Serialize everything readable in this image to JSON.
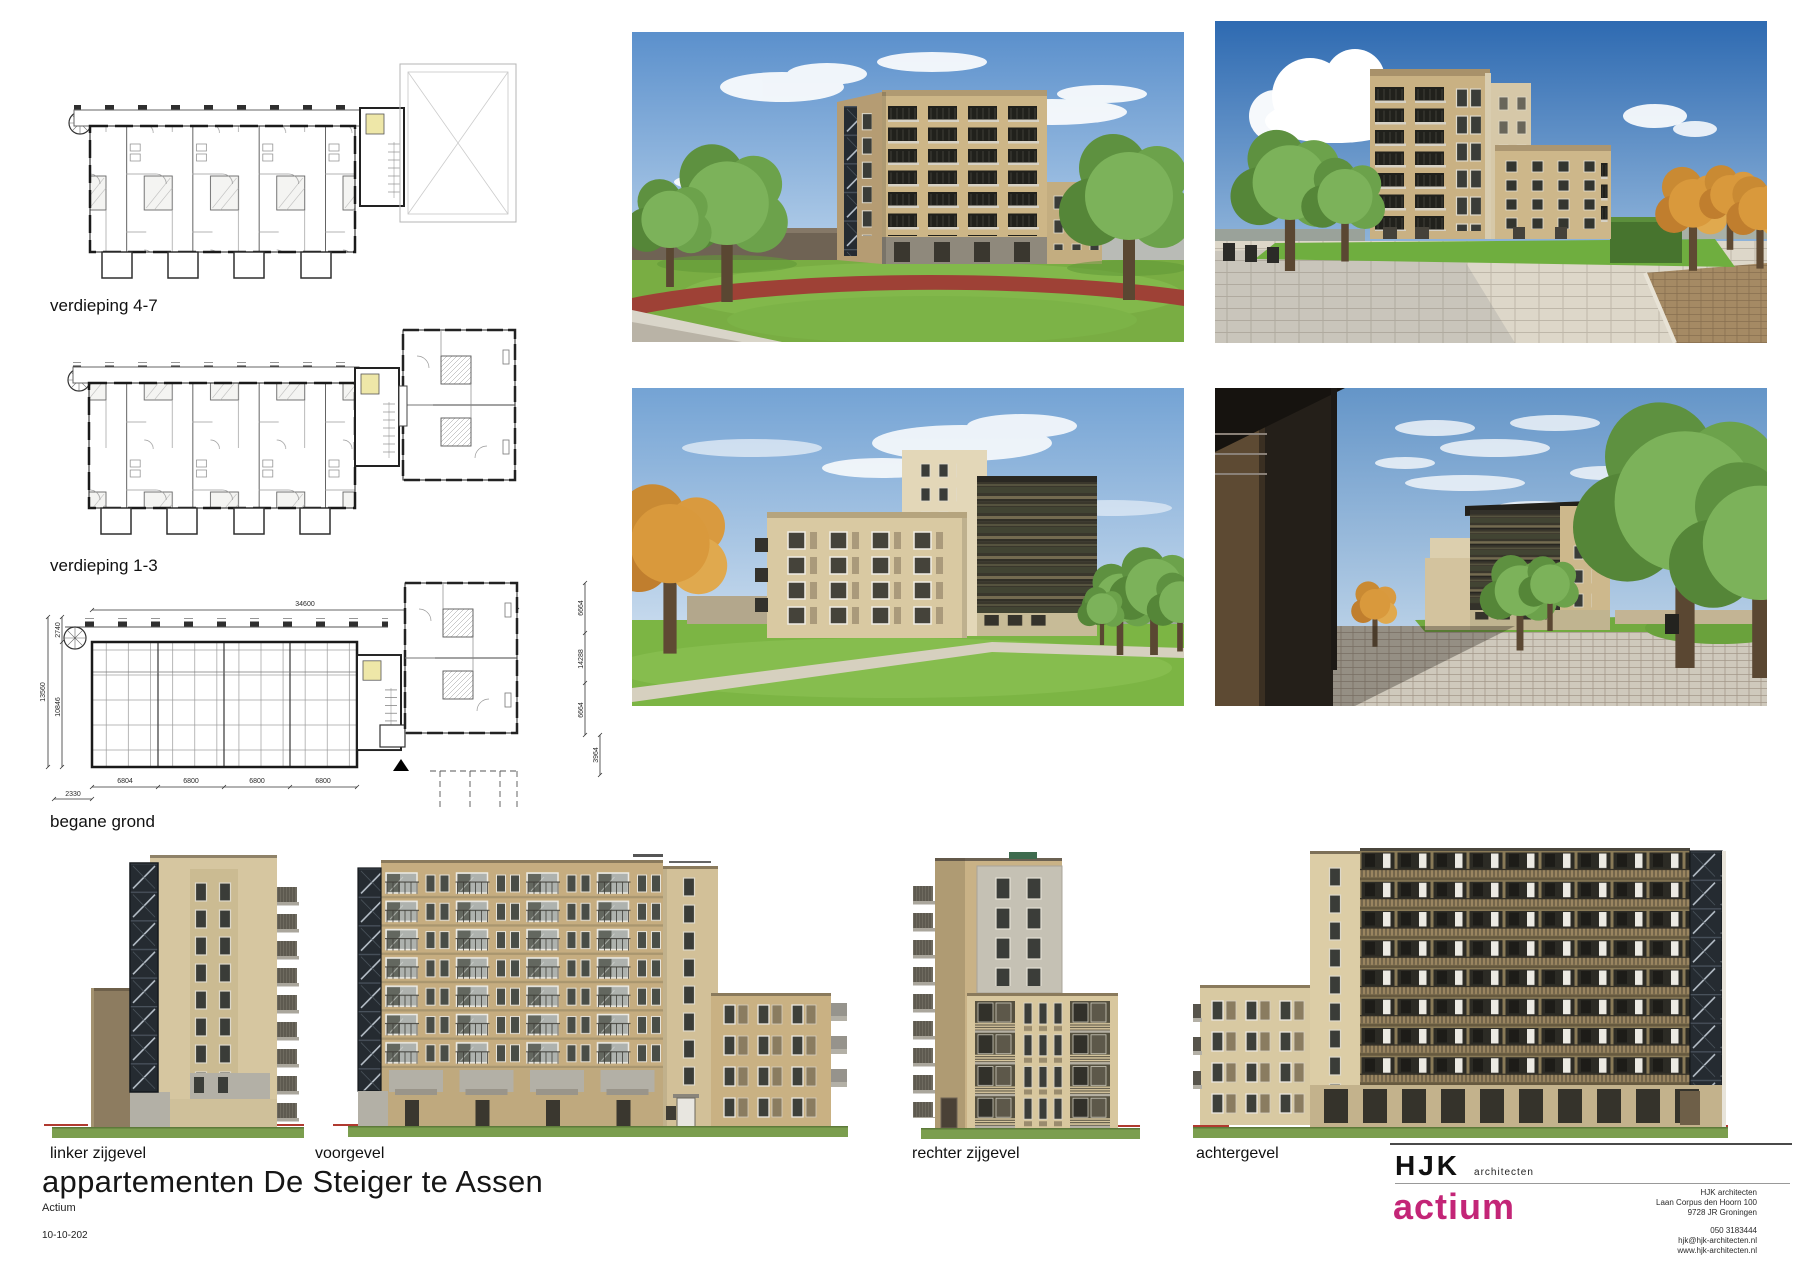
{
  "sheet": {
    "title": "appartementen De Steiger te Assen",
    "client": "Actium",
    "date": "10-10-202"
  },
  "plans": {
    "plan47": {
      "label": "verdieping 4-7"
    },
    "plan13": {
      "label": "verdieping 1-3"
    },
    "bg": {
      "label": "begane grond",
      "dims": {
        "top": "34600",
        "left_outer": "13560",
        "left_upper": "2740",
        "left_inner": "10846",
        "bottom": [
          "6804",
          "6800",
          "6800",
          "6800"
        ],
        "bottom_left": "2330",
        "right": [
          "6664",
          "14288",
          "6664"
        ],
        "right_lower": "3964"
      }
    }
  },
  "elevations": {
    "left": {
      "label": "linker zijgevel"
    },
    "front": {
      "label": "voorgevel"
    },
    "right": {
      "label": "rechter zijgevel"
    },
    "rear": {
      "label": "achtergevel"
    }
  },
  "titleblock": {
    "firm": "HJK",
    "firm_suffix": "architecten",
    "client_logo": "actium",
    "address": [
      "HJK architecten",
      "Laan Corpus den Hoorn 100",
      "9728 JR Groningen"
    ],
    "contact": [
      "050 3183444",
      "hjk@hjk-architecten.nl",
      "www.hjk-architecten.nl"
    ]
  },
  "colors": {
    "actium_pink": "#c32577",
    "grass_green": "#7b9e4e",
    "brick_tan": "#cdb993",
    "glazing_dark": "#252b31",
    "ground_red": "#b03a30"
  }
}
